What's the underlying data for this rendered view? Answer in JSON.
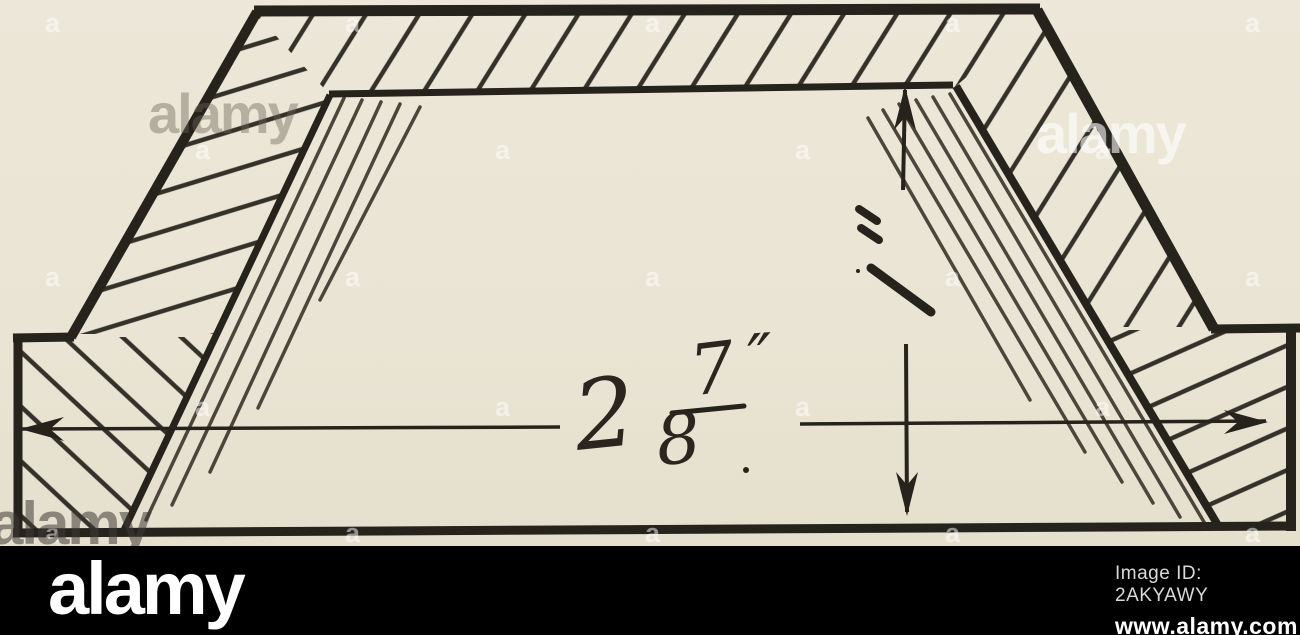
{
  "page": {
    "kind": "stock-photo of a sectional technical drawing"
  },
  "colors": {
    "paper": "#e9e4d3",
    "ink": "#26231d",
    "hatch": "#34312a",
    "shade": "#4a463c",
    "bar": "#000000",
    "logo": "#ffffff",
    "id_text": "#d9d9d9"
  },
  "drawing": {
    "dimension": {
      "whole": "2",
      "numerator": "7",
      "denominator": "8",
      "unit": "″"
    },
    "shapes": [
      {
        "name": "top-band-hatch",
        "kind": "polygon",
        "points": "256,15 1038,14 954,88 332,97",
        "fill": "hatchT"
      },
      {
        "name": "left-band-hatch",
        "kind": "polygon",
        "points": "74,334 258,16 331,96 217,334",
        "fill": "hatchL"
      },
      {
        "name": "left-flange-hatch",
        "kind": "polygon",
        "points": "19,337 216,337 125,529 19,529",
        "fill": "hatchLp"
      },
      {
        "name": "right-band-hatch",
        "kind": "polygon",
        "points": "1038,14 1212,327 1103,327 957,89",
        "fill": "hatchT"
      },
      {
        "name": "right-flange-hatch",
        "kind": "polygon",
        "points": "1104,330 1294,330 1294,528 1219,528",
        "fill": "hatchRp"
      },
      {
        "name": "shading-line",
        "kind": "line",
        "x1": 344,
        "y1": 98,
        "x2": 146,
        "y2": 520,
        "w": 3.5,
        "color": "shade",
        "cap": "round"
      },
      {
        "name": "shading-line",
        "kind": "line",
        "x1": 362,
        "y1": 100,
        "x2": 172,
        "y2": 505,
        "w": 3.5,
        "color": "shade",
        "cap": "round"
      },
      {
        "name": "shading-line",
        "kind": "line",
        "x1": 381,
        "y1": 102,
        "x2": 210,
        "y2": 472,
        "w": 3.5,
        "color": "shade",
        "cap": "round"
      },
      {
        "name": "shading-line",
        "kind": "line",
        "x1": 400,
        "y1": 104,
        "x2": 258,
        "y2": 408,
        "w": 3.5,
        "color": "shade",
        "cap": "round"
      },
      {
        "name": "shading-line",
        "kind": "line",
        "x1": 420,
        "y1": 107,
        "x2": 320,
        "y2": 300,
        "w": 3.5,
        "color": "shade",
        "cap": "round"
      },
      {
        "name": "shading-line",
        "kind": "line",
        "x1": 950,
        "y1": 94,
        "x2": 1204,
        "y2": 522,
        "w": 3.5,
        "color": "shade",
        "cap": "round"
      },
      {
        "name": "shading-line",
        "kind": "line",
        "x1": 933,
        "y1": 97,
        "x2": 1180,
        "y2": 517,
        "w": 3.5,
        "color": "shade",
        "cap": "round"
      },
      {
        "name": "shading-line",
        "kind": "line",
        "x1": 916,
        "y1": 100,
        "x2": 1153,
        "y2": 503,
        "w": 3.5,
        "color": "shade",
        "cap": "round"
      },
      {
        "name": "shading-line",
        "kind": "line",
        "x1": 899,
        "y1": 104,
        "x2": 1122,
        "y2": 482,
        "w": 3.5,
        "color": "shade",
        "cap": "round"
      },
      {
        "name": "shading-line",
        "kind": "line",
        "x1": 883,
        "y1": 110,
        "x2": 1085,
        "y2": 452,
        "w": 3.5,
        "color": "shade",
        "cap": "round"
      },
      {
        "name": "shading-line",
        "kind": "line",
        "x1": 868,
        "y1": 118,
        "x2": 1030,
        "y2": 400,
        "w": 3.5,
        "color": "shade",
        "cap": "round"
      },
      {
        "name": "outer-top-edge",
        "kind": "line",
        "x1": 254,
        "y1": 11,
        "x2": 1040,
        "y2": 9,
        "w": 11
      },
      {
        "name": "outer-left-slope",
        "kind": "line",
        "x1": 257,
        "y1": 12,
        "x2": 71,
        "y2": 337,
        "w": 10
      },
      {
        "name": "left-ledge",
        "kind": "line",
        "x1": 74,
        "y1": 337,
        "x2": 13,
        "y2": 338,
        "w": 9
      },
      {
        "name": "left-edge",
        "kind": "line",
        "x1": 18,
        "y1": 336,
        "x2": 18,
        "y2": 533,
        "w": 9
      },
      {
        "name": "bottom-edge",
        "kind": "line",
        "x1": 13,
        "y1": 533,
        "x2": 1293,
        "y2": 526,
        "w": 9
      },
      {
        "name": "outer-right-slope",
        "kind": "line",
        "x1": 1037,
        "y1": 10,
        "x2": 1214,
        "y2": 329,
        "w": 11
      },
      {
        "name": "right-ledge",
        "kind": "line",
        "x1": 1211,
        "y1": 329,
        "x2": 1300,
        "y2": 328,
        "w": 9
      },
      {
        "name": "right-edge",
        "kind": "line",
        "x1": 1291,
        "y1": 327,
        "x2": 1291,
        "y2": 531,
        "w": 10
      },
      {
        "name": "inner-top-edge",
        "kind": "line",
        "x1": 329,
        "y1": 94,
        "x2": 953,
        "y2": 85,
        "w": 7
      },
      {
        "name": "inner-left-slope",
        "kind": "line",
        "x1": 330,
        "y1": 95,
        "x2": 124,
        "y2": 530,
        "w": 7
      },
      {
        "name": "inner-right-slope",
        "kind": "line",
        "x1": 956,
        "y1": 86,
        "x2": 1219,
        "y2": 527,
        "w": 8
      },
      {
        "name": "width-dim-line-left",
        "kind": "line",
        "x1": 22,
        "y1": 429,
        "x2": 560,
        "y2": 427,
        "w": 3.5
      },
      {
        "name": "width-dim-line-right",
        "kind": "line",
        "x1": 800,
        "y1": 424,
        "x2": 1266,
        "y2": 421,
        "w": 3.5
      },
      {
        "name": "height-dim-line-upper",
        "kind": "line",
        "x1": 905,
        "y1": 90,
        "x2": 903,
        "y2": 190,
        "w": 4
      },
      {
        "name": "height-dim-line-lower",
        "kind": "line",
        "x1": 906,
        "y1": 344,
        "x2": 907,
        "y2": 512,
        "w": 4
      },
      {
        "name": "width-dim-arrow-left",
        "kind": "arrow",
        "points": "20,429 64,417 50,429 64,441"
      },
      {
        "name": "width-dim-arrow-right",
        "kind": "arrow",
        "points": "1268,422 1224,410 1238,422 1224,434"
      },
      {
        "name": "height-dim-arrow-up",
        "kind": "arrow",
        "points": "905,86 894,130 905,117 916,130"
      },
      {
        "name": "height-dim-arrow-down",
        "kind": "arrow",
        "points": "907,516 896,472 907,485 918,472"
      },
      {
        "name": "hand-mark",
        "kind": "line",
        "x1": 859,
        "y1": 209,
        "x2": 877,
        "y2": 221,
        "w": 8,
        "cap": "round"
      },
      {
        "name": "hand-mark",
        "kind": "line",
        "x1": 861,
        "y1": 228,
        "x2": 879,
        "y2": 240,
        "w": 8,
        "cap": "round"
      },
      {
        "name": "hand-mark",
        "kind": "line",
        "x1": 871,
        "y1": 268,
        "x2": 931,
        "y2": 312,
        "w": 9,
        "cap": "round"
      },
      {
        "name": "fraction-bar",
        "kind": "line",
        "x1": 672,
        "y1": 413,
        "x2": 744,
        "y2": 406,
        "w": 5,
        "cap": "round"
      },
      {
        "name": "ink-speck",
        "kind": "dot",
        "cx": 858,
        "cy": 271,
        "r": 2
      },
      {
        "name": "label-period",
        "kind": "dot",
        "cx": 746,
        "cy": 470,
        "r": 3
      }
    ]
  },
  "watermarks": {
    "tile_letter": "a",
    "brand_text": "alamy",
    "tiles": [
      {
        "x": 45,
        "y": 8
      },
      {
        "x": 345,
        "y": 8
      },
      {
        "x": 645,
        "y": 8
      },
      {
        "x": 945,
        "y": 8
      },
      {
        "x": 1245,
        "y": 8
      },
      {
        "x": 195,
        "y": 135
      },
      {
        "x": 495,
        "y": 135
      },
      {
        "x": 795,
        "y": 135
      },
      {
        "x": 1095,
        "y": 135
      },
      {
        "x": 45,
        "y": 262
      },
      {
        "x": 345,
        "y": 262
      },
      {
        "x": 645,
        "y": 262
      },
      {
        "x": 945,
        "y": 262
      },
      {
        "x": 1245,
        "y": 262
      },
      {
        "x": 195,
        "y": 392
      },
      {
        "x": 495,
        "y": 392
      },
      {
        "x": 795,
        "y": 392
      },
      {
        "x": 1095,
        "y": 392
      },
      {
        "x": 45,
        "y": 518
      },
      {
        "x": 345,
        "y": 518
      },
      {
        "x": 645,
        "y": 518
      },
      {
        "x": 945,
        "y": 518
      },
      {
        "x": 1245,
        "y": 518
      }
    ],
    "brand": [
      {
        "x": 148,
        "y": 86,
        "size": 56,
        "color": "rgba(105,99,86,0.42)"
      },
      {
        "x": 1036,
        "y": 106,
        "size": 56,
        "color": "rgba(255,255,255,0.6)"
      },
      {
        "x": -10,
        "y": 494,
        "size": 60,
        "color": "rgba(62,59,53,0.55)"
      }
    ]
  },
  "footer": {
    "logo": "alamy",
    "image_id": "Image ID: 2AKYAWY",
    "url": "www.alamy.com"
  }
}
